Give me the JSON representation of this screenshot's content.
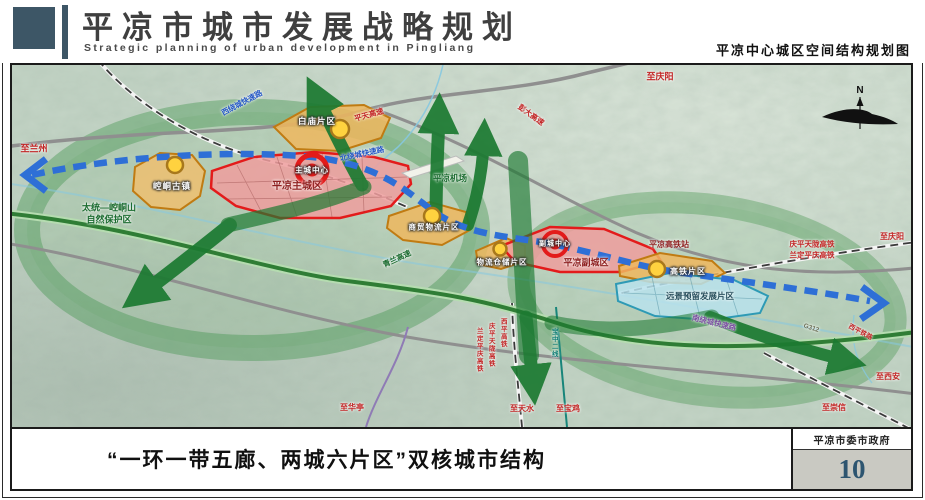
{
  "header": {
    "title_cn": "平凉市城市发展战略规划",
    "title_en": "Strategic planning of urban development in Pingliang",
    "map_title": "平凉中心城区空间结构规划图"
  },
  "footer": {
    "caption": "“一环一带五廊、两城六片区”双核城市结构",
    "agency": "平凉市委市政府",
    "page_number": "10"
  },
  "map": {
    "compass": "N",
    "labels": [
      {
        "t": "至兰州",
        "x": 22,
        "y": 84,
        "c": "red",
        "s": 9
      },
      {
        "t": "太统—崆峒山",
        "x": 97,
        "y": 143,
        "c": "green",
        "s": 9
      },
      {
        "t": "自然保护区",
        "x": 97,
        "y": 155,
        "c": "green",
        "s": 9
      },
      {
        "t": "崆峒古镇",
        "x": 160,
        "y": 121,
        "c": "zone",
        "s": 8.5
      },
      {
        "t": "平凉主城区",
        "x": 285,
        "y": 122,
        "c": "darkred",
        "s": 10,
        "b": 1
      },
      {
        "t": "主城中心",
        "x": 300,
        "y": 105,
        "c": "white",
        "s": 7.5,
        "b": 1
      },
      {
        "t": "白庙片区",
        "x": 305,
        "y": 56,
        "c": "zone",
        "s": 8.5
      },
      {
        "t": "西绕城快速路",
        "x": 230,
        "y": 38,
        "c": "blue",
        "s": 7.5,
        "r": -28
      },
      {
        "t": "平天高速",
        "x": 357,
        "y": 50,
        "c": "red",
        "s": 7.5,
        "r": -16
      },
      {
        "t": "北绕城快速路",
        "x": 350,
        "y": 89,
        "c": "blue",
        "s": 7.5,
        "r": -12
      },
      {
        "t": "彭大高速",
        "x": 519,
        "y": 50,
        "c": "red",
        "s": 7.5,
        "r": 36
      },
      {
        "t": "平凉机场",
        "x": 438,
        "y": 113,
        "c": "green",
        "s": 8.5
      },
      {
        "t": "至庆阳",
        "x": 648,
        "y": 12,
        "c": "red",
        "s": 9
      },
      {
        "t": "庆平天陇高铁",
        "x": 800,
        "y": 179,
        "c": "red",
        "s": 7.5
      },
      {
        "t": "兰定平庆高铁",
        "x": 800,
        "y": 190,
        "c": "red",
        "s": 7.5
      },
      {
        "t": "至庆阳",
        "x": 880,
        "y": 172,
        "c": "red",
        "s": 8
      },
      {
        "t": "平凉高铁站",
        "x": 657,
        "y": 180,
        "c": "darkred",
        "s": 8,
        "b": 1
      },
      {
        "t": "高铁片区",
        "x": 676,
        "y": 207,
        "c": "zone",
        "s": 8
      },
      {
        "t": "远景预留发展片区",
        "x": 688,
        "y": 231,
        "c": "slate",
        "s": 8.5,
        "b": 1
      },
      {
        "t": "南绕城快速路",
        "x": 702,
        "y": 258,
        "c": "purple",
        "s": 7.5,
        "r": 14
      },
      {
        "t": "商贸物流片区",
        "x": 422,
        "y": 162,
        "c": "zone",
        "s": 7.5
      },
      {
        "t": "物流仓储片区",
        "x": 490,
        "y": 197,
        "c": "zone",
        "s": 7.5
      },
      {
        "t": "副城中心",
        "x": 543,
        "y": 179,
        "c": "white",
        "s": 7,
        "b": 1
      },
      {
        "t": "平凉副城区",
        "x": 574,
        "y": 198,
        "c": "darkred",
        "s": 9,
        "b": 1
      },
      {
        "t": "青兰高速",
        "x": 385,
        "y": 194,
        "c": "green",
        "s": 7.5,
        "r": -25
      },
      {
        "t": "至华亭",
        "x": 340,
        "y": 343,
        "c": "red",
        "s": 8
      },
      {
        "t": "至天水",
        "x": 510,
        "y": 344,
        "c": "red",
        "s": 8
      },
      {
        "t": "至宝鸡",
        "x": 556,
        "y": 344,
        "c": "red",
        "s": 8
      },
      {
        "t": "兰定平庆高铁",
        "x": 466,
        "y": 285,
        "c": "red",
        "s": 6.5,
        "v": 1
      },
      {
        "t": "庆平天陇高铁",
        "x": 478,
        "y": 280,
        "c": "red",
        "s": 6.5,
        "v": 1
      },
      {
        "t": "西平高铁",
        "x": 490,
        "y": 268,
        "c": "red",
        "s": 6.5,
        "v": 1
      },
      {
        "t": "宝中二线",
        "x": 541,
        "y": 278,
        "c": "teal",
        "s": 6.5,
        "v": 1
      },
      {
        "t": "至西安",
        "x": 876,
        "y": 312,
        "c": "red",
        "s": 8
      },
      {
        "t": "至崇信",
        "x": 822,
        "y": 343,
        "c": "red",
        "s": 8
      },
      {
        "t": "西平铁路",
        "x": 848,
        "y": 268,
        "c": "red",
        "s": 6.5,
        "r": 28
      },
      {
        "t": "G312",
        "x": 799,
        "y": 264,
        "c": "gray",
        "s": 6.5,
        "r": 18
      }
    ]
  },
  "colors": {
    "accent_dark_slate": "#3d5666",
    "page_number_blue": "#2d5570",
    "zone_red_fill": "#ef9d9d",
    "zone_red_border": "#e31b1b",
    "zone_orange_fill": "#efb75e",
    "zone_orange_border": "#c07b12",
    "zone_cyan_fill": "#b9e2ec",
    "corridor_green": "#1d7a32",
    "transit_blue": "#2e6fd6",
    "node_yellow": "#ffd23f"
  }
}
